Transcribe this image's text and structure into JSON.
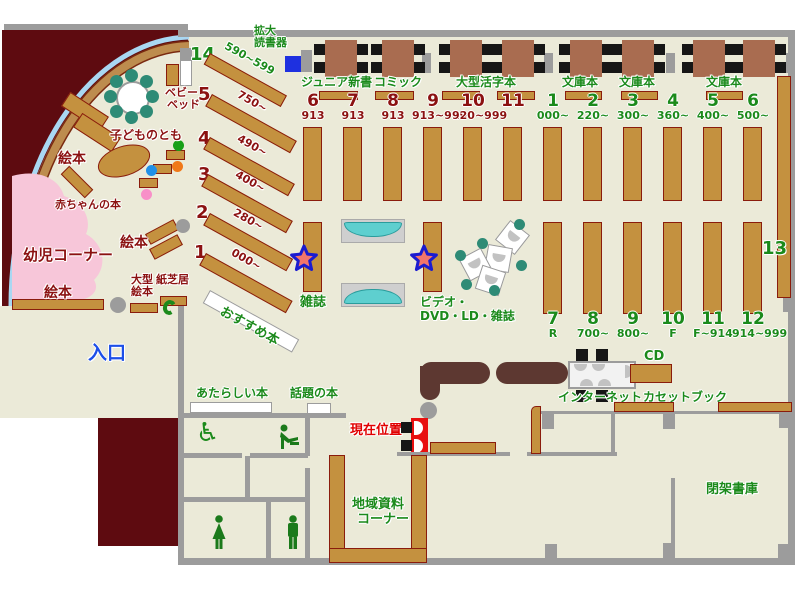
{
  "title": "library-floor-map",
  "colors": {
    "floor": "#ebead8",
    "outside": "#5e0b10",
    "wall": "#9c9c9c",
    "shelf": "#c4913f",
    "counter": "#5d3831",
    "pink_area": "#f7c6d9",
    "green_text": "#1b8a1b",
    "red_text": "#8b1111",
    "entrance_blue": "#1d4fe8",
    "device_blue": "#1e30e0",
    "bench_teal": "#5ecfcf",
    "chair_teal": "#2e8b76",
    "star_fill": "#f4756a",
    "star_border": "#1b1bd0",
    "sky_line": "#a9d7f2"
  },
  "icons": {
    "wheelchair": "♿",
    "star": "you-are-interest-star",
    "phone": "C"
  },
  "kids": {
    "corner": "幼児コーナー",
    "ehon_top": "絵本",
    "ehon_mid": "絵本",
    "ehon_bottom": "絵本",
    "baby_books": "赤ちゃんの本",
    "kodomonotomo": "子どものとも",
    "baby_bed_l1": "ベビー",
    "baby_bed_l2": "ベッド",
    "ogata_l1": "大型",
    "ogata_l2": "絵本",
    "kamishibai": "紙芝居"
  },
  "entrance": {
    "label": "入口"
  },
  "top": {
    "kakudai_l1": "拡大",
    "kakudai_l2": "読書器",
    "junior": "ジュニア新書",
    "comic": "コミック",
    "ogata_katsuji": "大型活字本",
    "bunko_a": "文庫本",
    "bunko_b": "文庫本",
    "bunko_c": "文庫本"
  },
  "shelves": {
    "left": [
      {
        "no": "14",
        "range": "590~599"
      },
      {
        "no": "5",
        "range": "750~"
      },
      {
        "no": "4",
        "range": "490~"
      },
      {
        "no": "3",
        "range": "400~"
      },
      {
        "no": "2",
        "range": "280~"
      },
      {
        "no": "1",
        "range": "000~"
      }
    ],
    "child": [
      {
        "no": "6",
        "range": "913"
      },
      {
        "no": "7",
        "range": "913"
      },
      {
        "no": "8",
        "range": "913"
      },
      {
        "no": "9",
        "range": "913~919"
      },
      {
        "no": "10",
        "range": "920~999"
      },
      {
        "no": "11",
        "range": ""
      }
    ],
    "adult_top": [
      {
        "no": "1",
        "range": "000~"
      },
      {
        "no": "2",
        "range": "220~"
      },
      {
        "no": "3",
        "range": "300~"
      },
      {
        "no": "4",
        "range": "360~"
      },
      {
        "no": "5",
        "range": "400~"
      },
      {
        "no": "6",
        "range": "500~"
      }
    ],
    "adult_bottom": [
      {
        "no": "7",
        "range": "R"
      },
      {
        "no": "8",
        "range": "700~"
      },
      {
        "no": "9",
        "range": "800~"
      },
      {
        "no": "10",
        "range": "F"
      },
      {
        "no": "11",
        "range": "F~914"
      },
      {
        "no": "12",
        "range": "914~999"
      }
    ],
    "no13": "13"
  },
  "center": {
    "magazines": "雑誌",
    "video_l1": "ビデオ・",
    "video_l2": "DVD・LD・雑誌",
    "recommend": "おすすめ本"
  },
  "services": {
    "cd": "CD",
    "internet": "インターネット",
    "cassette": "カセットブック"
  },
  "bottom": {
    "new_books": "あたらしい本",
    "topic_books": "話題の本",
    "you_are_here": "現在位置",
    "local_l1": "地域資料",
    "local_l2": "コーナー",
    "closed_stacks": "閉架書庫"
  }
}
